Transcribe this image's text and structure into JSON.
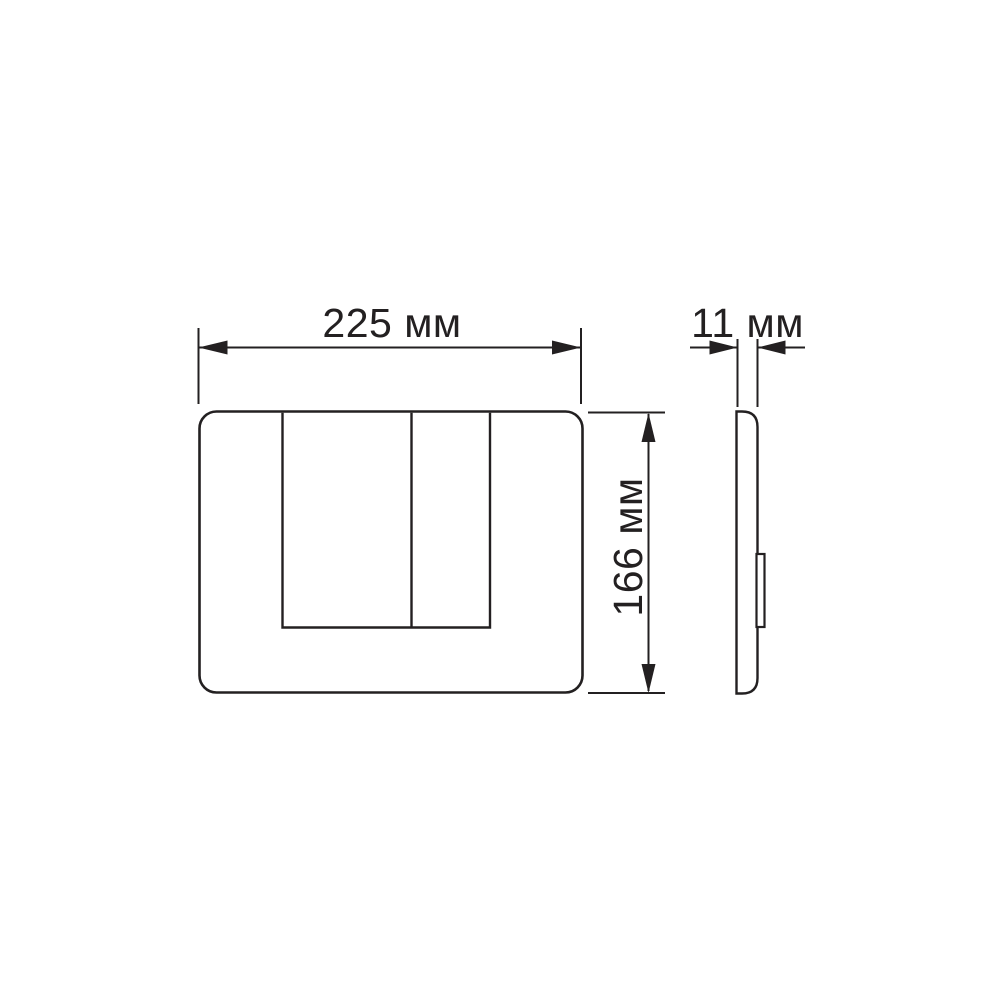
{
  "drawing": {
    "background_color": "#ffffff",
    "line_color": "#232021",
    "dimensions": {
      "width": {
        "label": "225 мм",
        "value": 225,
        "unit": "мм"
      },
      "height": {
        "label": "166 мм",
        "value": 166,
        "unit": "мм"
      },
      "depth": {
        "label": "11 мм",
        "value": 11,
        "unit": "мм"
      }
    }
  }
}
